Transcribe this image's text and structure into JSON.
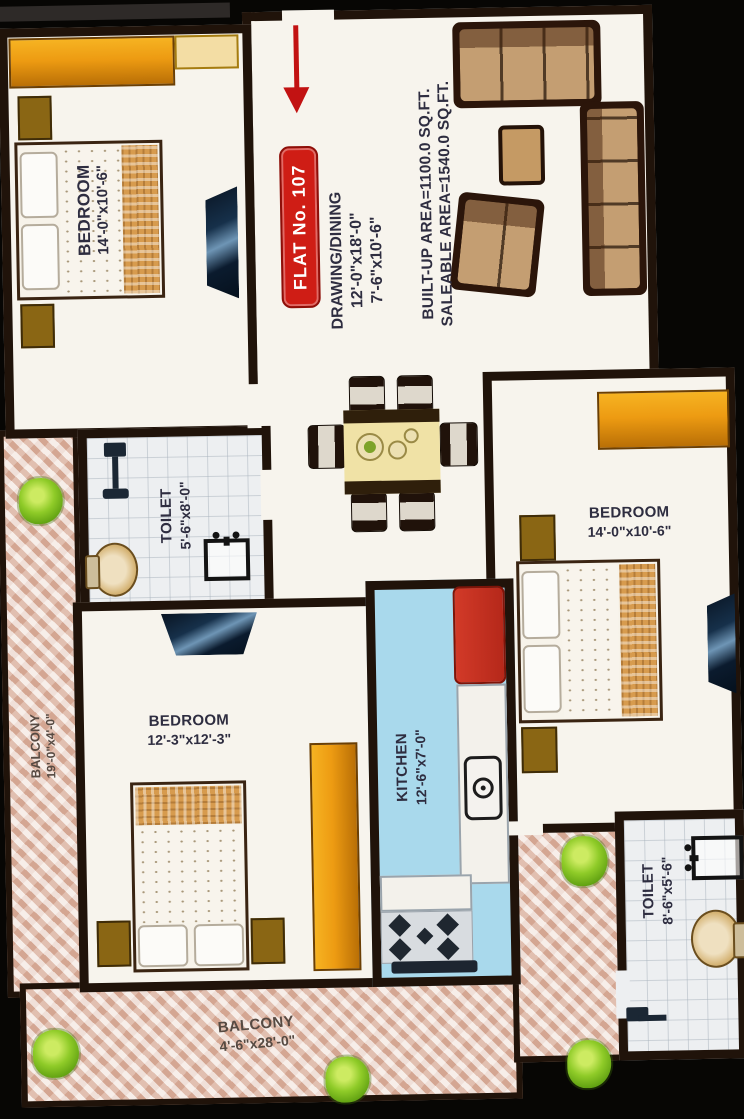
{
  "title": "FLAT No. 107 Floor Plan",
  "badge": {
    "label": "FLAT No. 107",
    "color": "#cf1d15"
  },
  "drawing_dining": {
    "name": "DRAWING/DINING",
    "dim1": "12'-0\"x18'-0\"",
    "dim2": "7'-6\"x10'-6\""
  },
  "area_summary": {
    "built_up": "BUILT-UP AREA=1100.0 SQ.FT.",
    "saleable": "SALEABLE AREA=1540.0 SQ.FT."
  },
  "rooms": {
    "bedroom_top_left": {
      "name": "BEDROOM",
      "dims": "14'-0\"x10'-6\""
    },
    "bedroom_right": {
      "name": "BEDROOM",
      "dims": "14'-0\"x10'-6\""
    },
    "bedroom_center": {
      "name": "BEDROOM",
      "dims": "12'-3\"x12'-3\""
    },
    "toilet_upper": {
      "name": "TOILET",
      "dims": "5'-6\"x8'-0\""
    },
    "toilet_lower": {
      "name": "TOILET",
      "dims": "8'-6\"x5'-6\""
    },
    "kitchen": {
      "name": "KITCHEN",
      "dims": "12'-6\"x7'-0\""
    },
    "balcony_left": {
      "name": "BALCONY",
      "dims": "19'-0\"x4'-0\""
    },
    "balcony_bottom": {
      "name": "BALCONY",
      "dims": "4'-6\"x28'-0\""
    }
  },
  "colors": {
    "wall": "#20130a",
    "floor": "#f7f4ed",
    "badge_red": "#cf1d15",
    "arrow_red": "#c21212",
    "wardrobe_orange": "#ed9b12",
    "kitchen_floor_blue": "#a9d9ec",
    "fridge_red": "#c22b1d",
    "balcony_tile": "#e0bba8",
    "plant_green": "#8fcb28"
  }
}
